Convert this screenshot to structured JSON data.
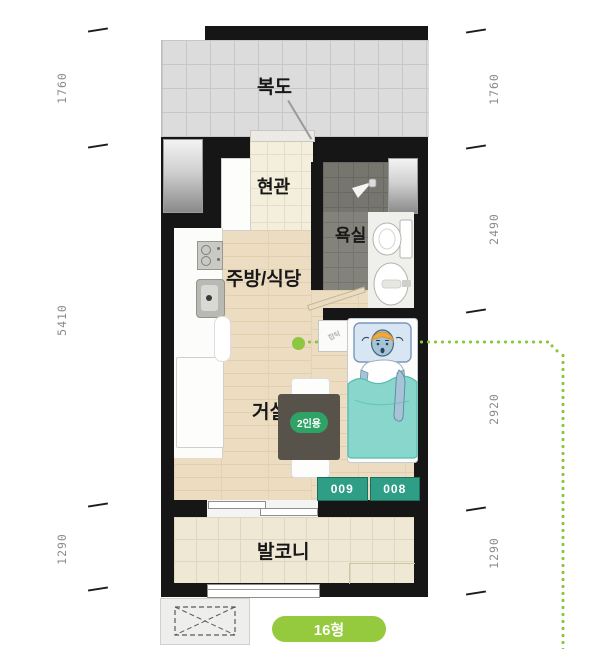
{
  "rooms": {
    "corridor": "복도",
    "entrance": "현관",
    "bathroom": "욕실",
    "kitchen_dining": "주방/식당",
    "living": "거실",
    "balcony": "발코니"
  },
  "labels": {
    "table_capacity": "2인용",
    "nightstand": "협탁",
    "type_badge": "16형"
  },
  "unit_numbers": [
    "009",
    "008"
  ],
  "dimensions": {
    "left": [
      "1760",
      "5410",
      "1290"
    ],
    "right": [
      "1760",
      "2490",
      "2920",
      "1290"
    ]
  },
  "icons": [
    "shower-icon",
    "toilet-icon",
    "washbasin-icon",
    "cooktop-icon",
    "kitchen-sink-icon",
    "ac-outdoor-unit-icon",
    "bed-person-illustration"
  ],
  "colors": {
    "accent_green": "#8dc63f",
    "type_badge_green": "#95c93e",
    "unit_badge_teal": "#2f9e86",
    "table_badge_green": "#2fa266",
    "blanket_teal": "#87d6cc",
    "wall_black": "#161616"
  }
}
